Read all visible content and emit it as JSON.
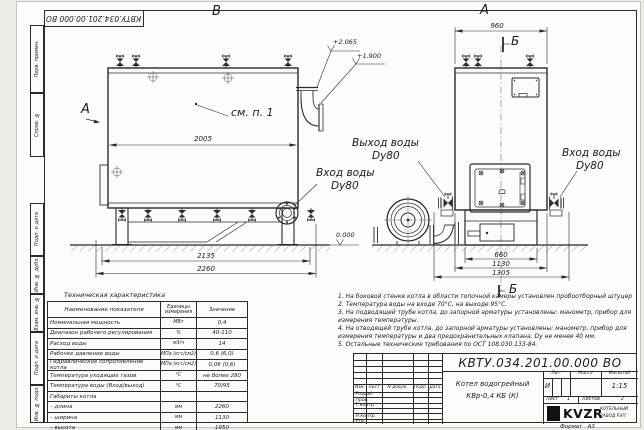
{
  "frame": {
    "stamp_number": "КВТУ.034.201.00.000  ВО",
    "format_label": "Формат",
    "format_value": "А3"
  },
  "side_strip": {
    "top": [
      "Перв. примен.",
      "Справ. №"
    ],
    "bottom": [
      "Подп. и дата",
      "Инв. № дубл.",
      "Взам. инв. №",
      "Подп. и дата",
      "Инв. № подл."
    ]
  },
  "left_view": {
    "view_label": "В",
    "dir_label": "А",
    "callout": "см. п. 1",
    "dim_inner": "2005",
    "dim_frame": "2135",
    "dim_overall": "2260",
    "elev_chimney": "+2.065",
    "elev_top": "+1.900",
    "elev_ground": "0.000",
    "inlet_line1": "Вход воды",
    "inlet_line2": "Dу80"
  },
  "right_view": {
    "view_label": "А",
    "section_letter": "Б",
    "section_ref": "Б",
    "dim_top": "960",
    "outlet_line1": "Выход воды",
    "outlet_line2": "Dу80",
    "inlet_line1": "Вход воды",
    "inlet_line2": "Dу80",
    "dim_base": "660",
    "dim_body": "1130",
    "dim_overall": "1305"
  },
  "spec_table": {
    "title": "Техническая характеристика",
    "col_name": "Наименование показателя",
    "col_units_1": "Единицы",
    "col_units_2": "измерения",
    "col_value": "Значение",
    "rows": [
      {
        "n": "Номинальная мощность",
        "u": "МВт",
        "v": "0,4"
      },
      {
        "n": "Диапазон рабочего регулирования",
        "u": "%",
        "v": "40-110"
      },
      {
        "n": "Расход воды",
        "u": "м3/ч",
        "v": "14"
      },
      {
        "n": "Рабочее давление воды",
        "u": "МПа (кгс/см2)",
        "v": "0,6 (6,0)"
      },
      {
        "n": "Гидравлическое сопротивление котла",
        "u": "МПа (кгс/см2)",
        "v": "0,06 (0,6)"
      },
      {
        "n": "Температура уходящих газов",
        "u": "°С",
        "v": "не более 280"
      },
      {
        "n": "Температура воды (Вход/выход)",
        "u": "°С",
        "v": "70/95"
      },
      {
        "n": "Габариты котла",
        "u": "",
        "v": ""
      },
      {
        "n": "– длина",
        "u": "мм",
        "v": "2260"
      },
      {
        "n": "– ширина",
        "u": "мм",
        "v": "1130"
      },
      {
        "n": "– высота",
        "u": "мм",
        "v": "1950"
      }
    ]
  },
  "notes": [
    "1.  На боковой стенке котла в области топочной камеры установлен пробоотборный штуцер",
    "2.  Температура воды на входе 70°С, на выходе 95°С.",
    "3.  На подводящей трубе котла, до запорной арматуры установлены: манометр, прибор для измерения температуры.",
    "4.  На отводящей трубе котла, до запорной арматуры установлены: манометр, прибор для измерения температуры и два предохранительных клапана. Dу не менее 40 мм.",
    "5.  Остальные технические требования по ОСТ 108.030.133-84."
  ],
  "title_block": {
    "doc_number": "КВТУ.034.201.00.000  ВО",
    "product_line1": "Котел водогрейный",
    "product_line2": "КВр-0,4  КБ  (К)",
    "cols": {
      "izm": "Изм.",
      "list": "Лист",
      "doc": "N докум.",
      "sign": "Подп.",
      "date": "Дата"
    },
    "rows": [
      "Разраб.",
      "Пров.",
      "Т.контр.",
      "",
      "Н.контр.",
      "Утв."
    ],
    "lit_label": "Лит.",
    "mass_label": "Масса",
    "scale_label": "Масштаб",
    "lit_value": "И",
    "scale_value": "1:15",
    "sheet_label": "Лист",
    "sheet_value": "1",
    "sheets_label": "Листов",
    "sheets_value": "2",
    "logo": "KVZR",
    "company_line1": "КОТЕЛЬНЫЙ",
    "company_line2": "ЗАВОД РЭП"
  }
}
